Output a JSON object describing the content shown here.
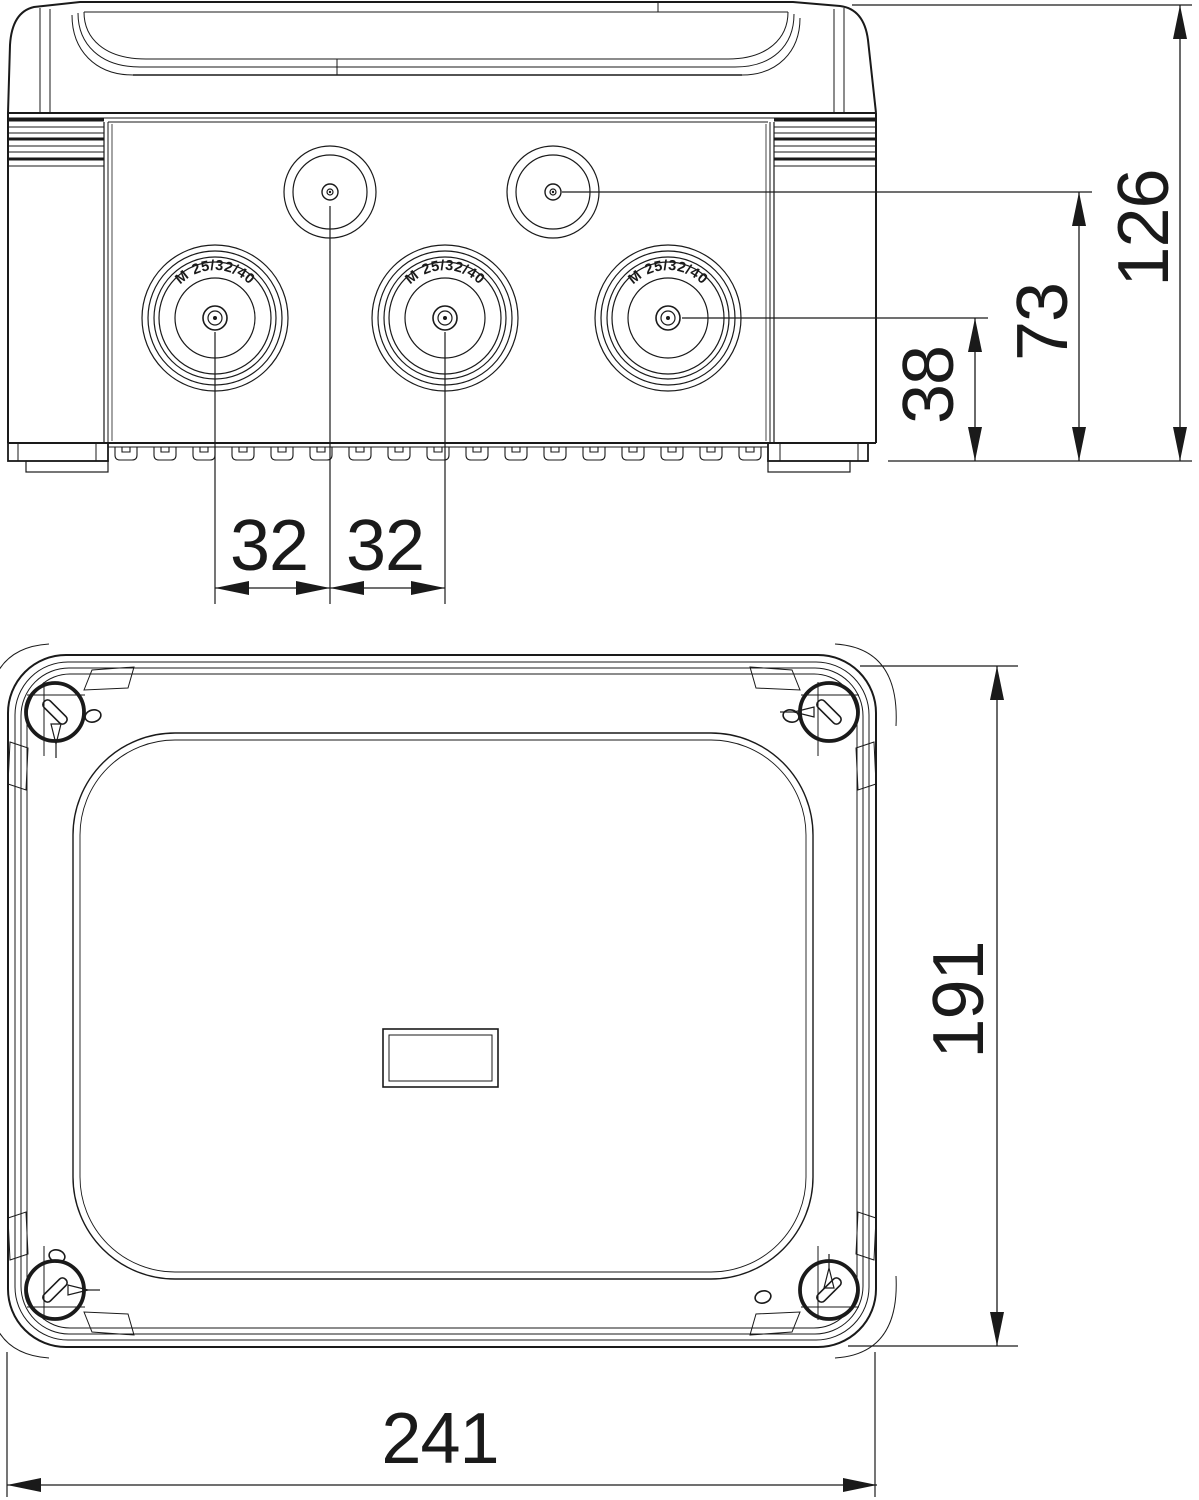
{
  "drawing": {
    "knockout_label": "M 25/32/40",
    "dimensions": {
      "overall_height": "126",
      "small_knockout_center_height": "73",
      "large_knockout_center_height": "38",
      "knockout_spacing_a": "32",
      "knockout_spacing_b": "32",
      "box_width": "241",
      "box_depth": "191"
    },
    "colors": {
      "line": "#1a1a1a",
      "background": "#ffffff"
    }
  }
}
